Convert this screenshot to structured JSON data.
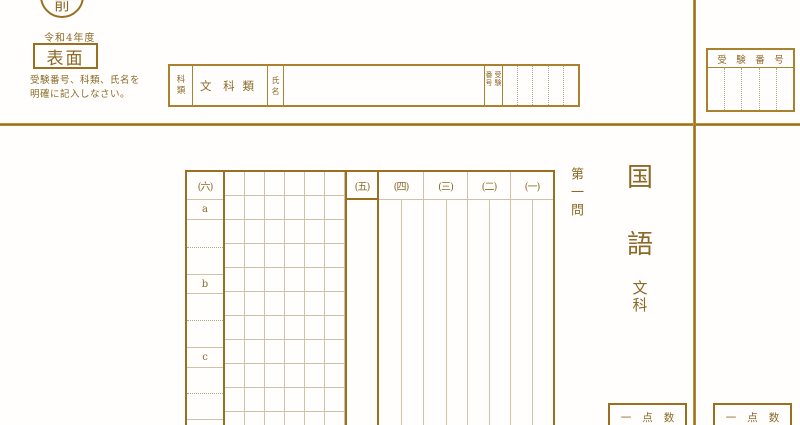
{
  "header": {
    "side_marker": "前",
    "year": "令和4年度",
    "face_label": "表面",
    "instructions": [
      "受験番号、科類、氏名を",
      "明確に記入しなさい。"
    ]
  },
  "form": {
    "category_label": [
      "科",
      "類"
    ],
    "category_value": {
      "prefix": "文 科",
      "suffix": "類"
    },
    "name_label": [
      "氏",
      "名"
    ],
    "name_value": "",
    "exam_no_label": [
      "受験",
      "番号"
    ],
    "exam_no_cell_count": 5
  },
  "exam_no_box": {
    "title": "受験番号",
    "cell_count": 5
  },
  "sheet": {
    "question_title": "第一問",
    "subject": [
      "国",
      "語"
    ],
    "track": [
      "文",
      "科"
    ],
    "col_headers": [
      "(六)",
      "(五)",
      "(四)",
      "(三)",
      "(二)",
      "(一)"
    ],
    "sub_labels": [
      "a",
      "b",
      "c"
    ],
    "score_label": "一点数"
  },
  "colors": {
    "line_dark": "#9a6f1f",
    "line_medium": "#a8822e",
    "line_light": "#cfc2a8",
    "line_dotted": "#b5a787",
    "text": "#8a6a28"
  }
}
